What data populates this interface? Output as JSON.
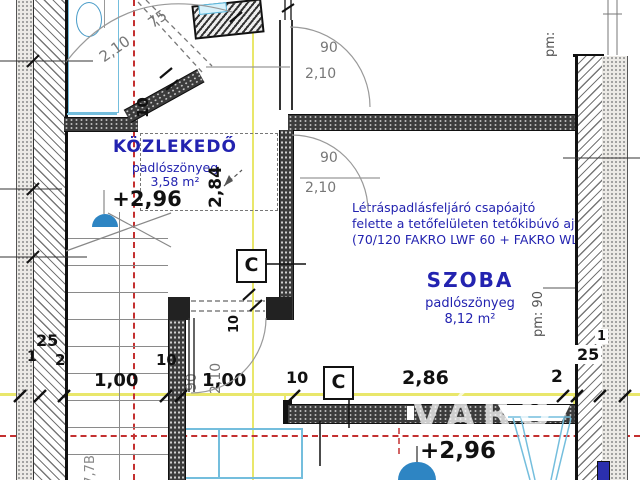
{
  "drawing_type": "floor plan (attic level) - Hungarian architectural drawing",
  "rooms": {
    "kozlekedo": {
      "name": "KÖZLEKEDŐ",
      "flooring": "padlószönyeg",
      "area": "3,58 m²",
      "level": "+2,96"
    },
    "szoba": {
      "name": "SZOBA",
      "flooring": "padlószönyeg",
      "area": "8,12 m²",
      "level": "+2,96"
    }
  },
  "note": {
    "line1": "Létráspadlásfeljáró csapóajtó",
    "line2": "felette a tetőfelületen tetőkibúvó ajtó",
    "line3": "(70/120 FAKRO LWF 60 + FAKRO WLI 54/8"
  },
  "section_markers": {
    "c1": "C",
    "c2": "C"
  },
  "dims": {
    "top_door_w": "75",
    "top_door_h": "2,10",
    "top_wall": "10",
    "door1_w": "90",
    "door1_h": "2,10",
    "door2_w": "90",
    "door2_h": "2,10",
    "door3_w": "90",
    "door3_h": "2,10",
    "door3_wall": "10",
    "hatch_height": "2,84",
    "pm90": "pm: 90",
    "pm_top": "pm:",
    "left_25": "25",
    "left_1": "1",
    "left_2": "2",
    "c100a": "1,00",
    "c10a": "10",
    "c100b": "1,00",
    "c10b": "10",
    "c286": "2,86",
    "c2": "2",
    "right_1": "1",
    "right_25": "25",
    "stair_label": "17,7B"
  },
  "watermark": "VÁRO",
  "colors": {
    "label_blue": "#2323b0",
    "axis_red": "#c43030",
    "section_yellow": "#e9e76b",
    "fixture_cyan": "#74bedd",
    "fixture_blue": "#2e85c3",
    "line_black": "#111111",
    "line_gray": "#888888"
  }
}
